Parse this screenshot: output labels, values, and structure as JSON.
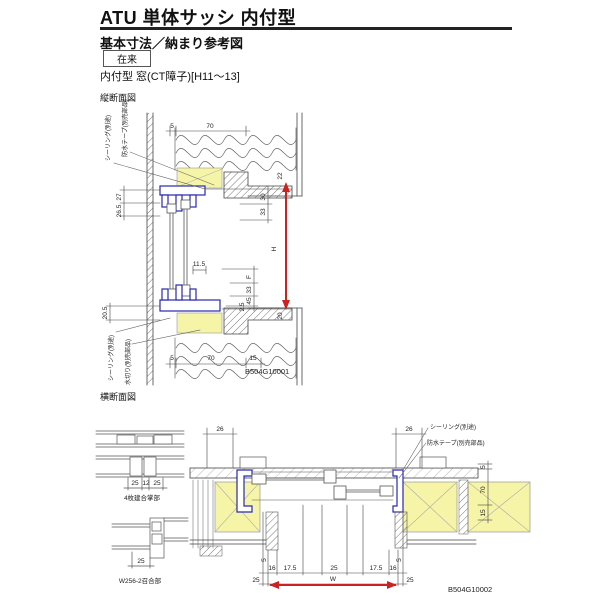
{
  "header": {
    "title": "ATU 単体サッシ 内付型",
    "subtitle": "基本寸法／納まり参考図",
    "tag": "在来",
    "spec": "内付型 窓(CT障子)[H11〜13]"
  },
  "vertical_section": {
    "label": "縦断面図",
    "code": "B504G10001",
    "callout_sealing_top": "シーリング(別途)",
    "callout_tape_top": "防水テープ(別売部品)",
    "callout_sealing_bottom": "シーリング(別途)",
    "callout_drip_bottom": "水切り(別売部品)",
    "dims": {
      "top_5": "5",
      "top_70": "70",
      "left_27": "27",
      "left_265": "26.5",
      "left_205": "20.5",
      "mid_115": "11.5",
      "right_22": "22",
      "right_30": "30",
      "right_33a": "33",
      "right_H": "H",
      "right_F": "F",
      "right_33b": "33",
      "right_45": "45",
      "right_25": "2.5",
      "right_20": "20",
      "bottom_5": "5",
      "bottom_70": "70",
      "bottom_15": "15"
    }
  },
  "horizontal_section": {
    "label": "横断面図",
    "code": "B504G10002",
    "callout_sealing": "シーリング(別途)",
    "callout_tape": "防水テープ(別売部品)",
    "detail_a": {
      "label": "4枚建合掌部",
      "dim_25a": "25",
      "dim_12": "12",
      "dim_25b": "25"
    },
    "detail_b": {
      "label": "W256-2召合部",
      "dim_25": "25"
    },
    "dims": {
      "left_26": "26",
      "right_26": "26",
      "wall_5": "5",
      "wall_70": "70",
      "wall_15": "15",
      "jamb_5l": "5",
      "jamb_5r": "5",
      "b16l": "16",
      "b175l": "17.5",
      "b25c": "25",
      "b175r": "17.5",
      "b16r": "16",
      "out_25l": "25",
      "W": "W",
      "out_25r": "25"
    }
  },
  "colors": {
    "accent_blue": "#2929b0",
    "highlight_yellow": "#f6f4a6",
    "dim_red": "#cc2222"
  }
}
